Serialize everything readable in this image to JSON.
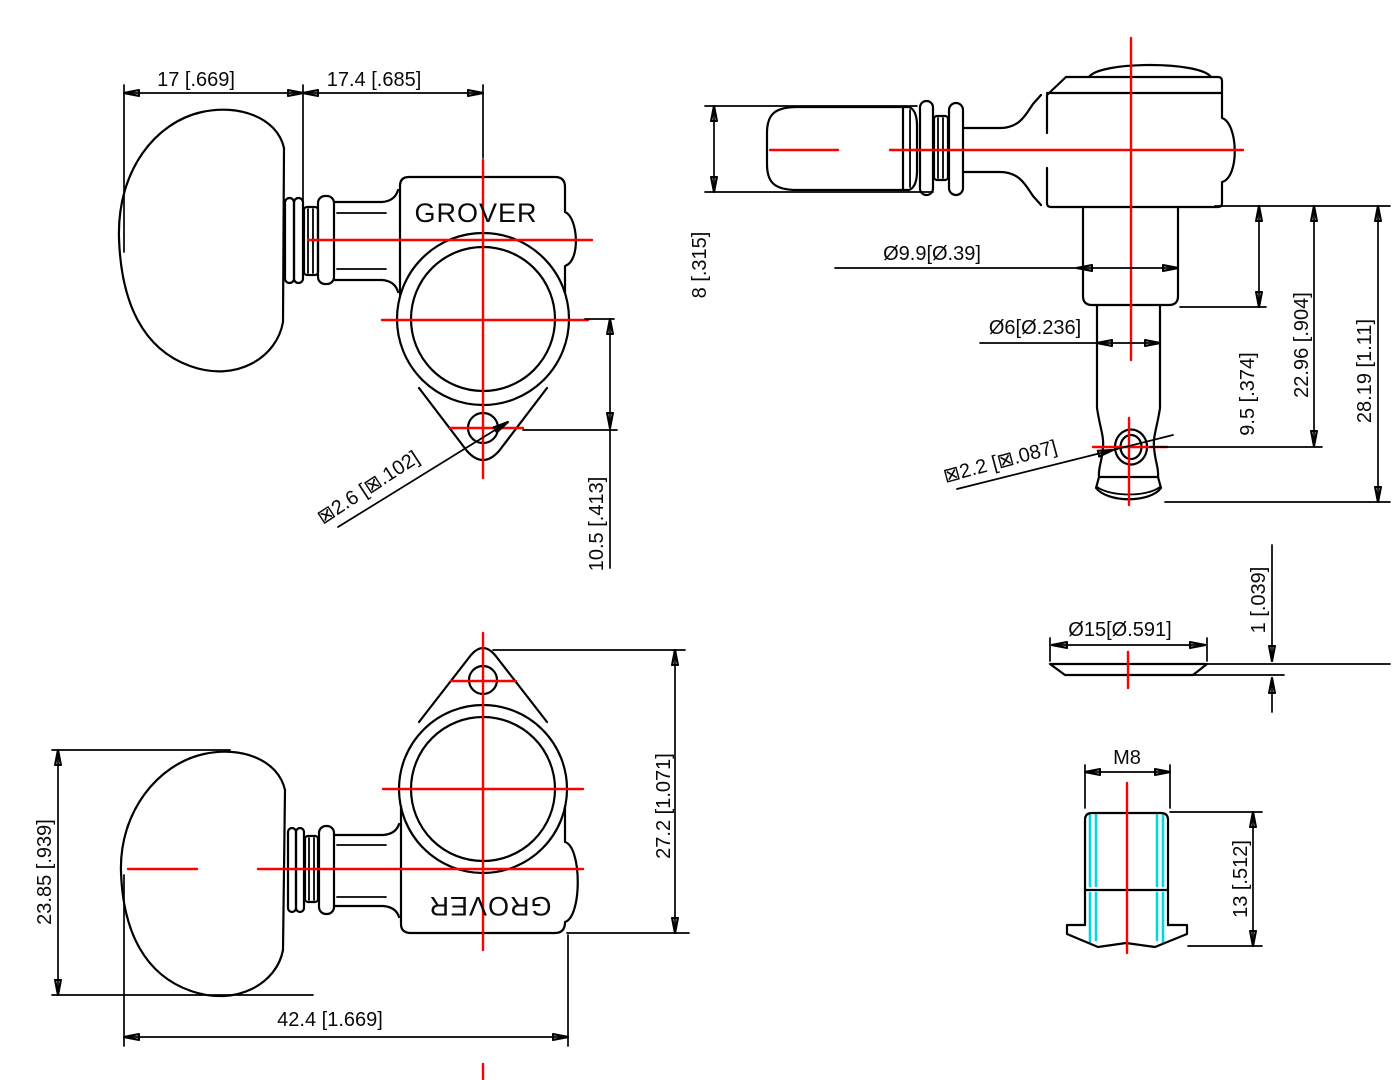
{
  "drawing": {
    "type": "technical-drawing",
    "subject": "guitar tuning machine head",
    "colors": {
      "outline": "#000000",
      "centerline": "#ff0000",
      "thread_highlight": "#00d8e8",
      "background": "#ffffff"
    },
    "views": {
      "front": {
        "brand": "GROVER",
        "knob_width": "17 [.669]",
        "post_offset": "17.4 [.685]",
        "screw_hole_dia": "⊠2.6 [⊠.102]",
        "hole_drop": "10.5 [.413]"
      },
      "side": {
        "knob_thickness": "8 [.315]",
        "post_dia": "Ø9.9[Ø.39]",
        "shaft_dia": "Ø6[Ø.236]",
        "string_hole_dia": "⊠2.2 [⊠.087]",
        "post_len": "9.5 [.374]",
        "shaft_len": "22.96 [.904]",
        "total_len": "28.19 [1.11]"
      },
      "rear": {
        "brand": "GROVER",
        "knob_height": "23.85 [.939]",
        "overall_width": "42.4 [1.669]",
        "body_height": "27.2 [1.071]"
      },
      "washer": {
        "outer_dia": "Ø15[Ø.591]",
        "thickness": "1 [.039]"
      },
      "bushing": {
        "thread": "M8",
        "height": "13 [.512]"
      }
    }
  }
}
